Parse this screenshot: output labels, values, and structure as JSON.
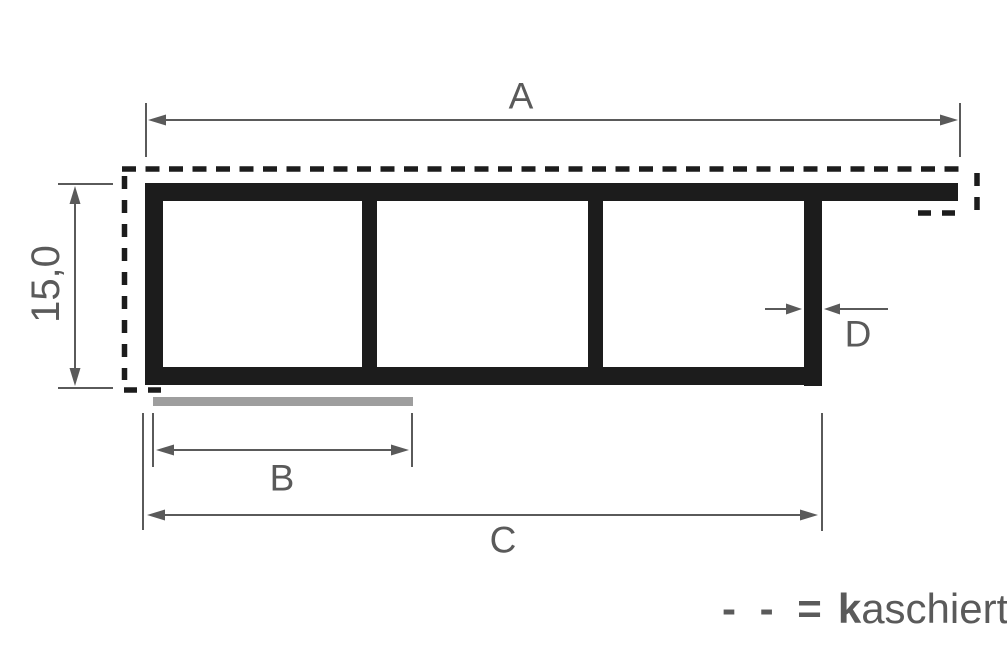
{
  "drawing": {
    "dimension_labels": {
      "width_top": "A",
      "laminate_strip_width": "B",
      "width_bottom": "C",
      "wall_thickness": "D",
      "profile_height": "15,0"
    },
    "legend": {
      "dash_symbol": "- - =",
      "term_bold_prefix": "k",
      "term_rest": "aschiert"
    },
    "colors": {
      "profile_black": "#1c1c1c",
      "dimension_gray": "#5a5a5a",
      "laminate_bar_gray": "#9e9e9e",
      "background": "#ffffff"
    }
  }
}
